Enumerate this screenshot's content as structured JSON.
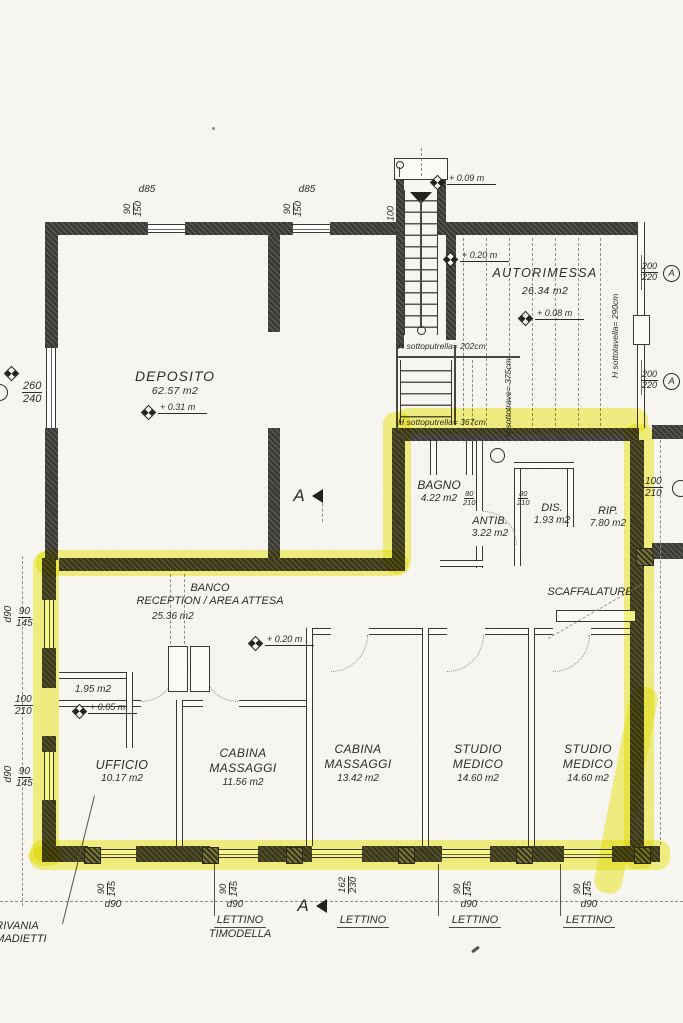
{
  "colors": {
    "highlighter": "#f3ef25",
    "ink": "#2e2c28",
    "paper": "#f6f5ef"
  },
  "rooms": {
    "deposito": {
      "name": "DEPOSITO",
      "area": "62.57 m2",
      "elev": "+ 0.31 m"
    },
    "autorimessa": {
      "name": "AUTORIMESSA",
      "area": "26.34 m2",
      "elev": "+ 0.08 m"
    },
    "bagno": {
      "name": "BAGNO",
      "area": "4.22 m2"
    },
    "antibagno": {
      "name": "ANTIB.",
      "area": "3.22 m2"
    },
    "disimpegno": {
      "name": "DIS.",
      "area": "1.93 m2"
    },
    "ripostiglio": {
      "name": "RIP.",
      "area": "7.80 m2"
    },
    "reception": {
      "name": "BANCO",
      "name2": "RECEPTION / AREA ATTESA",
      "area": "25.36 m2",
      "elev": "+ 0.20 m"
    },
    "anticamera": {
      "area": "1.95 m2",
      "elev": "+ 0.05 m"
    },
    "ufficio": {
      "name": "UFFICIO",
      "area": "10.17 m2"
    },
    "cabina_massaggi_1": {
      "name": "CABINA MASSAGGI",
      "area": "11.56 m2"
    },
    "cabina_massaggi_2": {
      "name": "CABINA MASSAGGI",
      "area": "13.42 m2"
    },
    "studio_medico_1": {
      "name": "STUDIO MEDICO",
      "area": "14.60 m2"
    },
    "studio_medico_2": {
      "name": "STUDIO MEDICO",
      "area": "14.60 m2"
    }
  },
  "stairs": {
    "elev_top": "+ 0.09 m",
    "elev_landing": "+ 0.20 m",
    "width_label": "100"
  },
  "heights": {
    "under_beam_stair": "H sottoputrella= 202cm",
    "under_beam_main": "H sottotrave= 375cm",
    "under_beam_low": "H sottoputrella= 367cm",
    "under_slab_garage": "H sottotavella= 290cm"
  },
  "dims": {
    "d85": "d85",
    "d90": "d90",
    "w90_150": {
      "w": "90",
      "h": "150"
    },
    "w90_145": {
      "w": "90",
      "h": "145"
    },
    "w260_240": {
      "w": "260",
      "h": "240"
    },
    "d100_210": {
      "w": "100",
      "h": "210"
    },
    "d200_220": {
      "w": "200",
      "h": "220"
    },
    "d162_230": {
      "w": "162",
      "h": "230"
    },
    "d80_210": {
      "w": "80",
      "h": "210"
    }
  },
  "markers": {
    "section_letter": "A",
    "window_type": "A"
  },
  "furniture": {
    "scaffalature": "SCAFFALATURE",
    "scrivania_line1": "SCRIVANIA",
    "scrivania_line2": "ARMADIETTI",
    "lettino": "LETTINO",
    "lettino_timodella_line1": "LETTINO",
    "lettino_timodella_line2": "TIMODELLA"
  }
}
